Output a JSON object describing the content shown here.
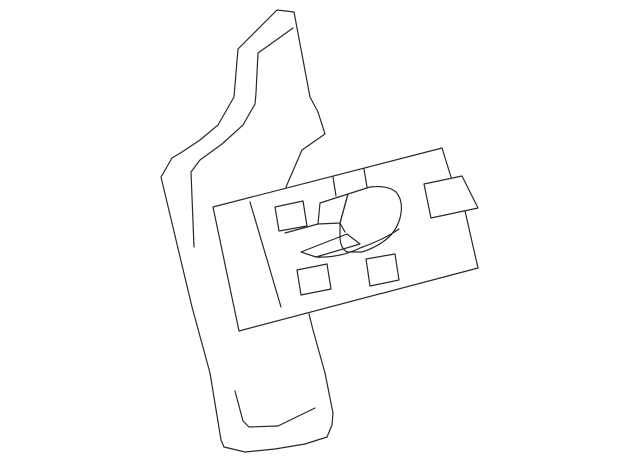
{
  "canvas": {
    "width": 640,
    "height": 464
  },
  "colors": {
    "background": "#ffffff",
    "line": "#282828"
  },
  "drawing": {
    "stroke_width": 1.2,
    "shapes": [
      {
        "name": "panel-outline",
        "type": "polyline",
        "points": [
          [
            309,
            314
          ],
          [
            313,
            330
          ],
          [
            325,
            373
          ],
          [
            333,
            413
          ],
          [
            332,
            425
          ],
          [
            327,
            437
          ],
          [
            305,
            444
          ],
          [
            275,
            449
          ],
          [
            245,
            452
          ],
          [
            224,
            447
          ],
          [
            221,
            440
          ],
          [
            210,
            373
          ],
          [
            192,
            307
          ],
          [
            161,
            177
          ],
          [
            172,
            158
          ],
          [
            182,
            152
          ],
          [
            200,
            140
          ],
          [
            218,
            125
          ],
          [
            234,
            97
          ],
          [
            238,
            49
          ],
          [
            277,
            10
          ],
          [
            294,
            12
          ],
          [
            310,
            97
          ],
          [
            318,
            112
          ],
          [
            325,
            134
          ],
          [
            302,
            150
          ],
          [
            286,
            187
          ]
        ]
      },
      {
        "name": "panel-inner-edge-line",
        "type": "polyline",
        "points": [
          [
            293,
            28
          ],
          [
            258,
            53
          ],
          [
            256,
            93
          ],
          [
            255,
            104
          ],
          [
            243,
            125
          ],
          [
            222,
            144
          ],
          [
            200,
            160
          ],
          [
            191,
            172
          ],
          [
            194,
            247
          ]
        ]
      },
      {
        "name": "panel-pocket-line",
        "type": "polyline",
        "points": [
          [
            235,
            391
          ],
          [
            243,
            421
          ],
          [
            249,
            427
          ],
          [
            278,
            426
          ],
          [
            315,
            408
          ]
        ]
      },
      {
        "name": "switch-plate-outline",
        "type": "path",
        "d": "M 451 177 L 442 148 L 213 207 L 239 331 L 478 268 L 465 211"
      },
      {
        "name": "plate-inner-line",
        "type": "polyline",
        "points": [
          [
            250,
            202
          ],
          [
            281,
            307
          ]
        ]
      },
      {
        "name": "plate-tick-left",
        "type": "polyline",
        "points": [
          [
            333,
            177
          ],
          [
            336,
            196
          ]
        ]
      },
      {
        "name": "plate-tick-right",
        "type": "polyline",
        "points": [
          [
            364,
            169
          ],
          [
            367,
            187
          ]
        ]
      },
      {
        "name": "button-hole-top-left",
        "type": "polygon",
        "points": [
          [
            275,
            207
          ],
          [
            303,
            201
          ],
          [
            307,
            226
          ],
          [
            279,
            231
          ]
        ]
      },
      {
        "name": "button-hole-bottom-left",
        "type": "polygon",
        "points": [
          [
            297,
            270
          ],
          [
            327,
            264
          ],
          [
            331,
            289
          ],
          [
            301,
            295
          ]
        ]
      },
      {
        "name": "button-hole-bottom-right",
        "type": "polygon",
        "points": [
          [
            366,
            259
          ],
          [
            395,
            254
          ],
          [
            399,
            280
          ],
          [
            370,
            286
          ]
        ]
      },
      {
        "name": "knob-flap",
        "type": "polygon",
        "points": [
          [
            320,
            203
          ],
          [
            348,
            194
          ],
          [
            340,
            223
          ],
          [
            318,
            224
          ]
        ]
      },
      {
        "name": "knob-base-line",
        "type": "polyline",
        "points": [
          [
            285,
            233
          ],
          [
            318,
            224
          ]
        ]
      },
      {
        "name": "knob-top",
        "type": "path",
        "d": "M 348 194 L 370 187 Q 388 185 396 192 Q 403 200 401 213 Q 399 227 389 237 Q 378 247 362 252 L 347 252 Q 340 248 340 236 L 340 223 Z"
      },
      {
        "name": "knob-fold-connector",
        "type": "polyline",
        "points": [
          [
            340,
            223
          ],
          [
            345,
            232
          ]
        ]
      },
      {
        "name": "knob-band",
        "type": "polygon",
        "points": [
          [
            301,
            252
          ],
          [
            347,
            234
          ],
          [
            360,
            244
          ],
          [
            316,
            257
          ]
        ]
      },
      {
        "name": "knob-skirt-curve",
        "type": "path",
        "d": "M 316 257 Q 340 258 360 248 Q 385 239 399 229"
      },
      {
        "name": "connector-tab",
        "type": "polygon",
        "points": [
          [
            424,
            184
          ],
          [
            462,
            176
          ],
          [
            478,
            208
          ],
          [
            431,
            218
          ]
        ]
      }
    ]
  }
}
